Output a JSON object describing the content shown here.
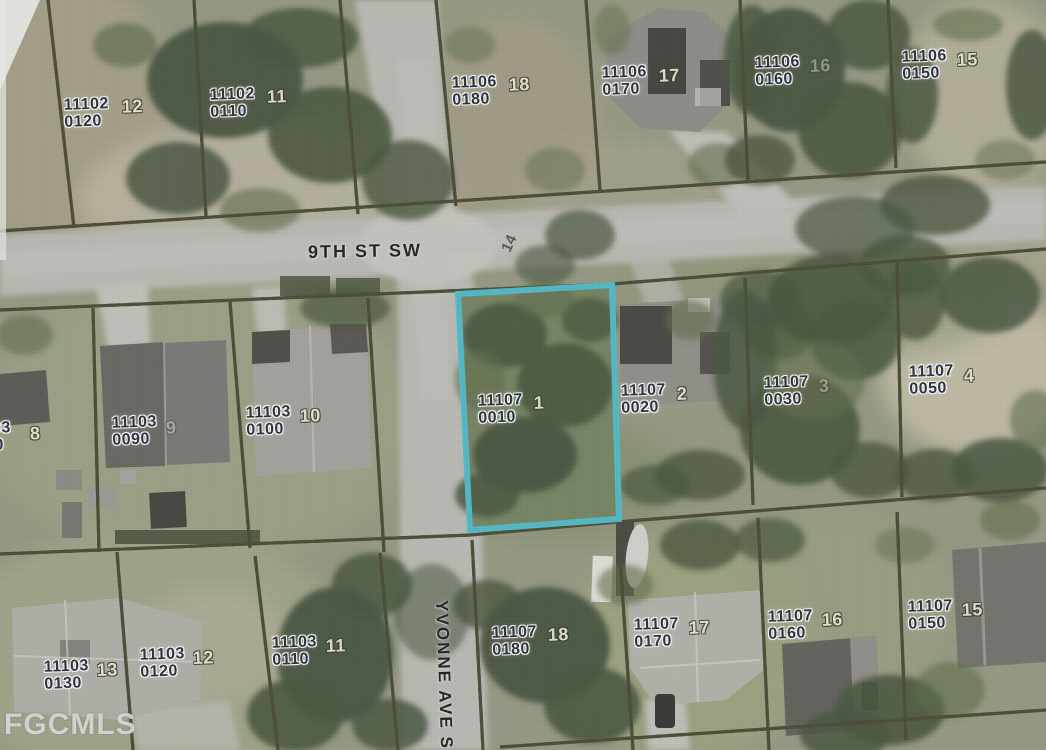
{
  "watermark": {
    "text": "FGCMLS"
  },
  "streets": [
    {
      "name": "9TH ST SW",
      "orientation": "horizontal"
    },
    {
      "name": "YVONNE AVE S",
      "orientation": "vertical"
    }
  ],
  "road_note": "14",
  "highlight": {
    "parcel_id": "11107",
    "parcel_suffix": "0010",
    "lot": "1",
    "outline_color": "#3fc1d3"
  },
  "parcels": [
    {
      "id": "11102",
      "suffix": "0120",
      "lot": "12",
      "x": 64,
      "y": 96,
      "lot_x": 122,
      "lot_y": 99
    },
    {
      "id": "11102",
      "suffix": "0110",
      "lot": "11",
      "x": 210,
      "y": 86,
      "lot_x": 267,
      "lot_y": 89
    },
    {
      "id": "11106",
      "suffix": "0180",
      "lot": "18",
      "x": 452,
      "y": 74,
      "lot_x": 509,
      "lot_y": 77
    },
    {
      "id": "11106",
      "suffix": "0170",
      "lot": "17",
      "x": 602,
      "y": 64,
      "lot_x": 659,
      "lot_y": 68
    },
    {
      "id": "11106",
      "suffix": "0160",
      "lot": "16",
      "x": 755,
      "y": 54,
      "lot_x": 810,
      "lot_y": 58,
      "faint": true
    },
    {
      "id": "11106",
      "suffix": "0150",
      "lot": "15",
      "x": 902,
      "y": 48,
      "lot_x": 957,
      "lot_y": 52
    },
    {
      "id": "11107",
      "suffix": "0010",
      "lot": "1",
      "x": 478,
      "y": 392,
      "lot_x": 534,
      "lot_y": 395,
      "highlighted": true
    },
    {
      "id": "11107",
      "suffix": "0020",
      "lot": "2",
      "x": 621,
      "y": 382,
      "lot_x": 677,
      "lot_y": 386
    },
    {
      "id": "11107",
      "suffix": "0030",
      "lot": "3",
      "x": 764,
      "y": 374,
      "lot_x": 819,
      "lot_y": 378,
      "faint": true
    },
    {
      "id": "11107",
      "suffix": "0050",
      "lot": "4",
      "x": 909,
      "y": 363,
      "lot_x": 964,
      "lot_y": 368
    },
    {
      "id": "11103",
      "suffix": "0080",
      "lot": "8",
      "x": -34,
      "y": 420,
      "lot_x": 30,
      "lot_y": 426
    },
    {
      "id": "11103",
      "suffix": "0090",
      "lot": "9",
      "x": 112,
      "y": 414,
      "lot_x": 166,
      "lot_y": 420,
      "faint": true
    },
    {
      "id": "11103",
      "suffix": "0100",
      "lot": "10",
      "x": 246,
      "y": 404,
      "lot_x": 300,
      "lot_y": 408
    },
    {
      "id": "11103",
      "suffix": "0130",
      "lot": "13",
      "x": 44,
      "y": 658,
      "lot_x": 97,
      "lot_y": 662
    },
    {
      "id": "11103",
      "suffix": "0120",
      "lot": "12",
      "x": 140,
      "y": 646,
      "lot_x": 193,
      "lot_y": 650
    },
    {
      "id": "11103",
      "suffix": "0110",
      "lot": "11",
      "x": 272,
      "y": 634,
      "lot_x": 326,
      "lot_y": 638
    },
    {
      "id": "11107",
      "suffix": "0180",
      "lot": "18",
      "x": 492,
      "y": 624,
      "lot_x": 548,
      "lot_y": 627
    },
    {
      "id": "11107",
      "suffix": "0170",
      "lot": "17",
      "x": 634,
      "y": 616,
      "lot_x": 689,
      "lot_y": 620
    },
    {
      "id": "11107",
      "suffix": "0160",
      "lot": "16",
      "x": 768,
      "y": 608,
      "lot_x": 822,
      "lot_y": 612
    },
    {
      "id": "11107",
      "suffix": "0150",
      "lot": "15",
      "x": 908,
      "y": 598,
      "lot_x": 962,
      "lot_y": 602
    }
  ],
  "palette": {
    "parcel_line_yellow": "#ece83e",
    "parcel_line_dark": "#3f4126",
    "road_gray": "#bcbbb3",
    "terrain_green": "#93977c",
    "tree_dark": "#3d4c31",
    "label_text": "#232834",
    "lot_text": "#f0e7d2",
    "highlight_cyan": "#3fc1d3"
  }
}
